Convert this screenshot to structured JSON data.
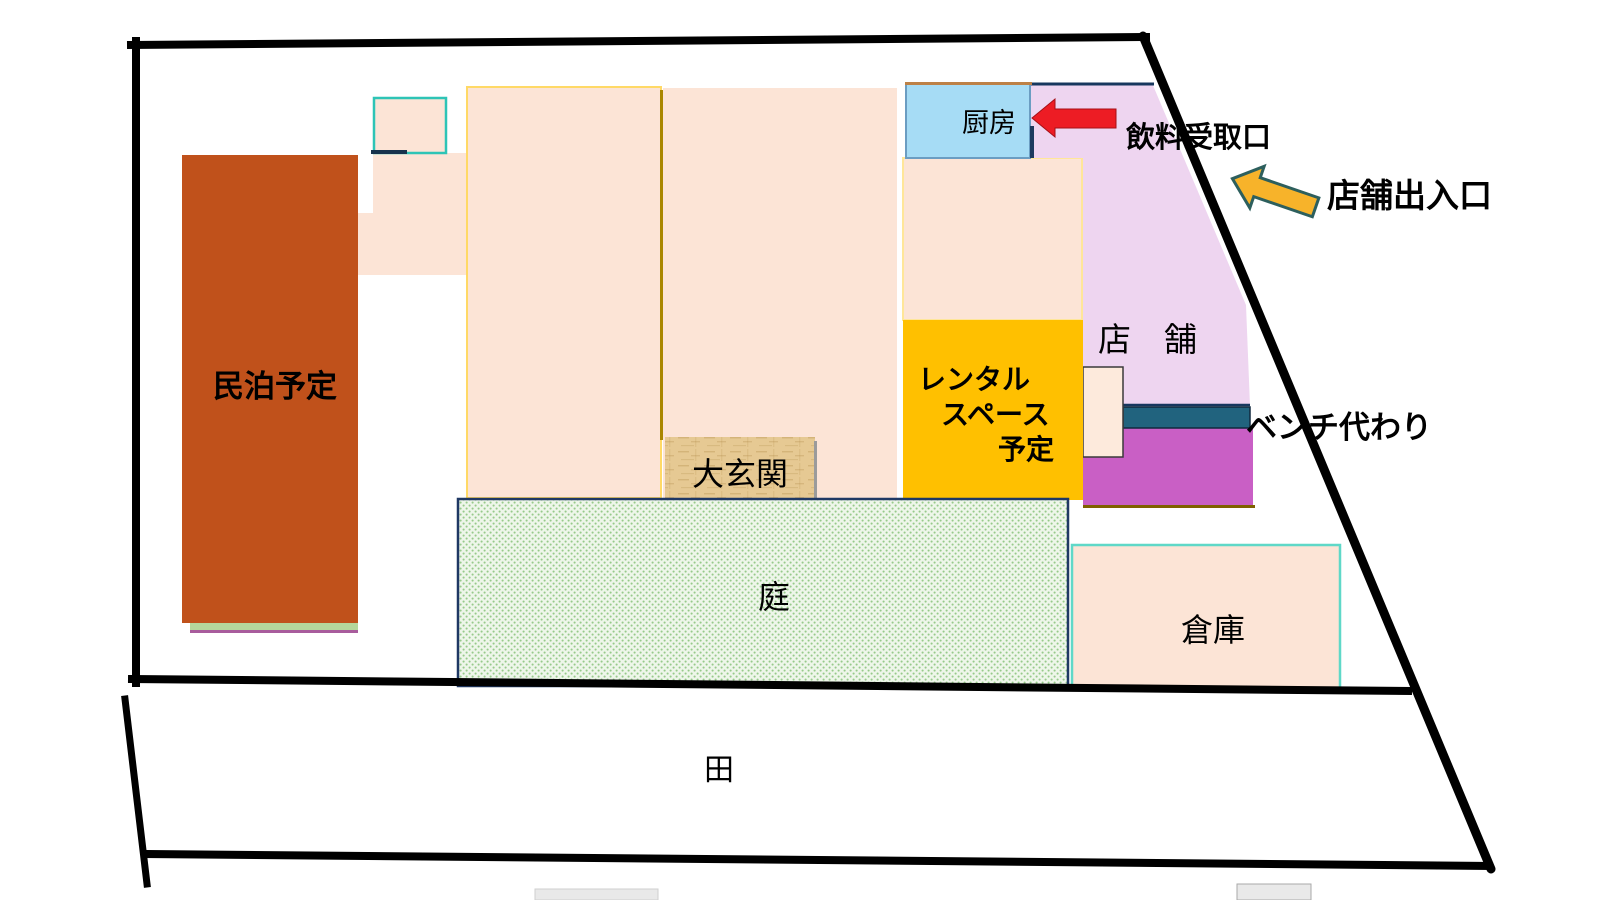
{
  "site_plan": {
    "labels": {
      "minpaku": "民泊予定",
      "kitchen": "厨房",
      "drink_pickup": "飲料受取口",
      "store_entrance": "店舗出入口",
      "store": "店　舗",
      "rental_line1": "レンタル",
      "rental_line2": "スペース",
      "rental_line3": "予定",
      "genkan": "大玄関",
      "bench": "ベンチ代わり",
      "garden": "庭",
      "warehouse": "倉庫",
      "field": "田"
    },
    "colors": {
      "boundary": "#000000",
      "minpaku_fill": "#c0511b",
      "minpaku_base_green": "#b5d69b",
      "minpaku_base_purple": "#a85c9c",
      "peach_fill": "#fce4d6",
      "peach_border_yellow": "#ffd966",
      "peach_border_pale": "#ffe699",
      "divider_olive": "#a98600",
      "kitchen_fill": "#a6dcf5",
      "kitchen_border": "#6b9dc2",
      "store_fill": "#eed5f0",
      "store_border_navy": "#17375e",
      "rental_fill": "#ffc000",
      "magenta_fill": "#c95fc5",
      "magenta_base": "#7f6000",
      "bench_teal": "#21637e",
      "side_room_fill": "#fdeadc",
      "garden_bg": "#eef6ea",
      "garden_dot": "#97ca8b",
      "garden_border": "#1f3864",
      "genkan_fill": "#e6c993",
      "genkan_grain": "#b08c48",
      "warehouse_border": "#5fd8c8",
      "teal_square_border": "#2ec4b6",
      "red_arrow": "#ed1c24",
      "yellow_arrow_fill": "#f7b32a",
      "yellow_arrow_border": "#2d5f5d",
      "gray_shape": "#e9e9e9"
    }
  }
}
